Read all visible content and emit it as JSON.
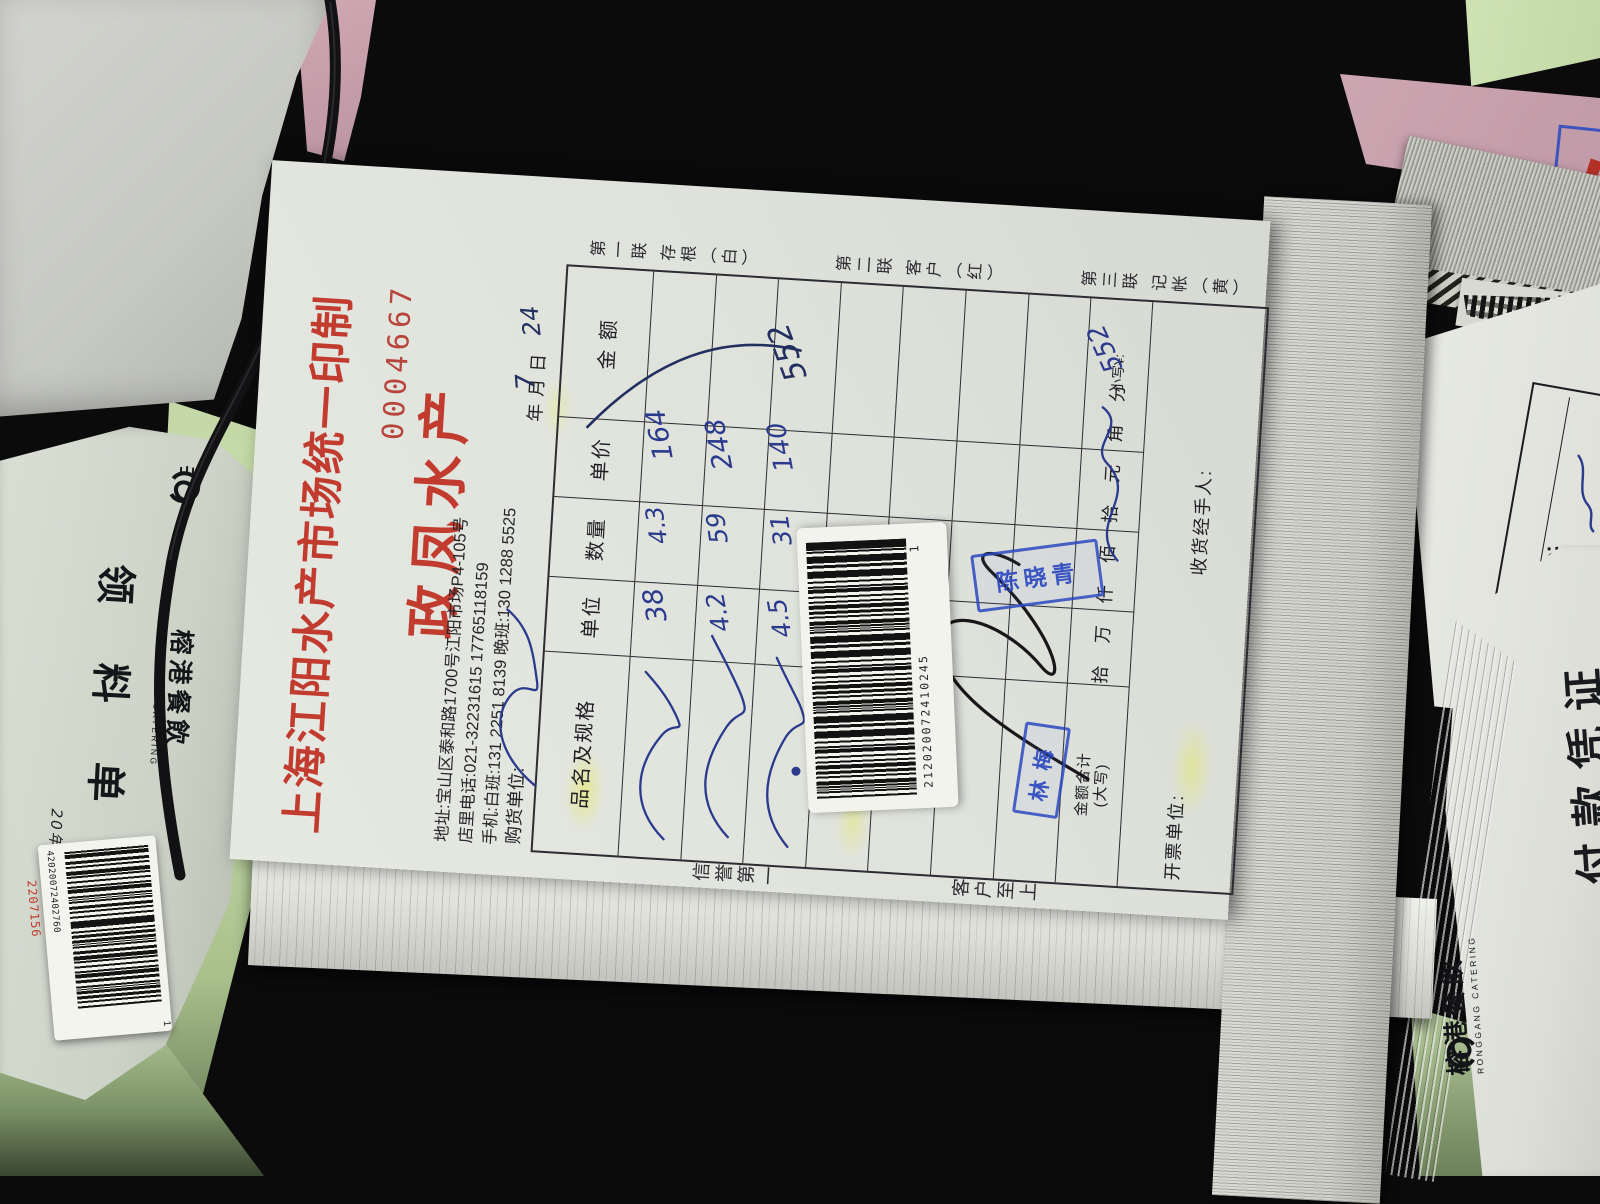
{
  "receipt": {
    "title": "上海江阳水产市场统一印制",
    "serial": "0004667",
    "vendor": "政凤水产",
    "address": "地址:宝山区泰和路1700号江阳市场P4-105号",
    "phone": "店里电话:021-32231615  17765118159",
    "mobile": "手机:白班:131 2251 8139  晚班:130 1288 5525",
    "purchaser_label": "购货单位:",
    "date_line": "年    月    日",
    "copies": [
      "第一联 存根（白）",
      "第二联 客户（红）",
      "第三联 记帐（黄）"
    ],
    "motto_top": "信誉第一",
    "motto_bottom": "客户至上",
    "table": {
      "columns": [
        "品名及规格",
        "单位",
        "数量",
        "单价",
        "金 额"
      ]
    },
    "sum_row": {
      "label_line1": "金额合计",
      "label_line2": "(大写)",
      "units": [
        "拾",
        "万",
        "仟",
        "佰",
        "拾",
        "元",
        "角",
        "分"
      ],
      "small_label": "小写¥:"
    },
    "footer": {
      "issuer_label": "开票单位:",
      "receiver_label": "收货经手人:"
    },
    "barcode": {
      "number": "212020072410245",
      "suffix": "1"
    },
    "stamps": {
      "stamp1": "陈晓青",
      "stamp2": "林梅"
    },
    "handwritten": {
      "month": "7",
      "day": "24",
      "rows": [
        {
          "name": "（草书品名）",
          "qty": "38",
          "price": "4.3",
          "amount": "164"
        },
        {
          "name": "（草书品名）",
          "qty": "4.2",
          "price": "59",
          "amount": "248"
        },
        {
          "name": "（草书品名）",
          "qty": "4.5",
          "price": "31",
          "amount": "140"
        }
      ],
      "total": "552",
      "total_small": "552",
      "total_cn": "伍佰伍拾贰（草书）"
    }
  },
  "left_doc": {
    "brand_cn": "榕港餐飲",
    "brand_en": "RONGGANG CATERING",
    "title": "领 料 单",
    "date_printed": "年   月   日",
    "date_handwritten": "20年7月24日",
    "sticker_number": "42020072402760",
    "sticker_flag": "1",
    "sticker_red_number": "2207156"
  },
  "right_doc": {
    "brand_cn": "榕港餐飲",
    "brand_en": "RONGGANG CATERING",
    "title": "付款凭证",
    "no_label": "No:"
  }
}
